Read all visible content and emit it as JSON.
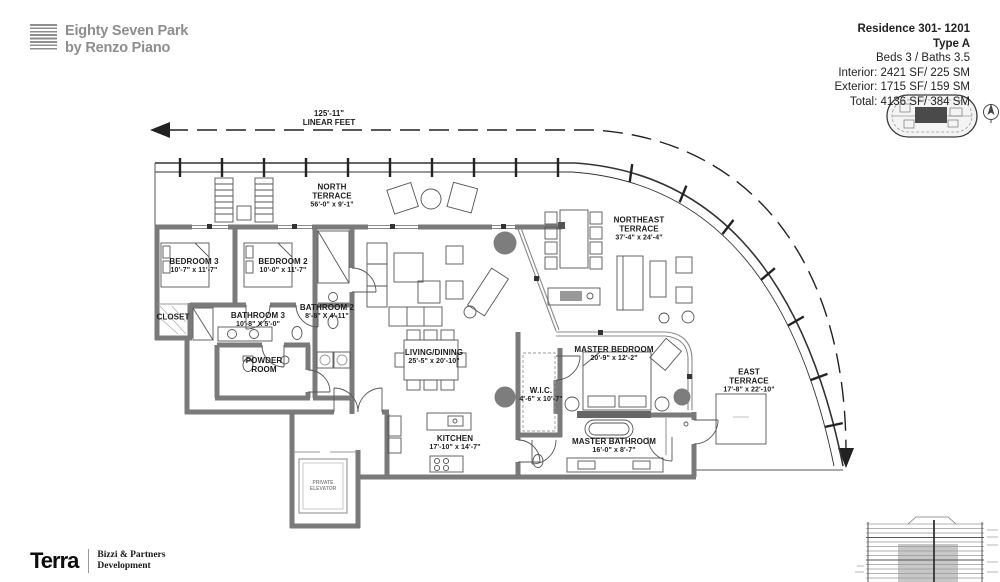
{
  "header": {
    "brand": {
      "line1": "Eighty Seven Park",
      "line2": "by Renzo Piano"
    },
    "residence": {
      "title": "Residence 301- 1201",
      "type": "Type A",
      "beds_baths": "Beds 3 / Baths 3.5",
      "interior": "Interior: 2421 SF/ 225 SM",
      "exterior": "Exterior: 1715 SF/ 159 SM",
      "total": "Total: 4136 SF/ 384 SM"
    }
  },
  "dimension_line": {
    "value": "125'-11\"",
    "label": "LINEAR FEET"
  },
  "rooms": {
    "north_terrace": {
      "name1": "NORTH",
      "name2": "TERRACE",
      "dims": "56'-0\" x 9'-1\""
    },
    "northeast_terrace": {
      "name1": "NORTHEAST",
      "name2": "TERRACE",
      "dims": "37'-4\" x 24'-4\""
    },
    "east_terrace": {
      "name1": "EAST",
      "name2": "TERRACE",
      "dims": "17'-8\" x 22'-10\""
    },
    "bedroom_3": {
      "name": "BEDROOM 3",
      "dims": "10'-7\" x 11'-7\""
    },
    "bedroom_2": {
      "name": "BEDROOM 2",
      "dims": "10'-0\" x 11'-7\""
    },
    "closet": {
      "name": "CLOSET"
    },
    "bathroom_3": {
      "name": "BATHROOM 3",
      "dims": "10'-8\" X 5'-0\""
    },
    "bathroom_2": {
      "name": "BATHROOM 2",
      "dims": "8'-8\" X 4'-11\""
    },
    "powder_room": {
      "name1": "POWDER",
      "name2": "ROOM"
    },
    "living_dining": {
      "name": "LIVING/DINING",
      "dims": "25'-5\" x 20'-10\""
    },
    "wic": {
      "name": "W.I.C.",
      "dims": "4'-6\" x 10'-7\""
    },
    "kitchen": {
      "name": "KITCHEN",
      "dims": "17'-10\" x 14'-7\""
    },
    "master_bedroom": {
      "name": "MASTER BEDROOM",
      "dims": "20'-9\" x 12'-2\""
    },
    "master_bathroom": {
      "name": "MASTER BATHROOM",
      "dims": "16'-0\" x 8'-7\""
    },
    "private_elevator": {
      "name1": "PRIVATE",
      "name2": "ELEVATOR"
    }
  },
  "footer": {
    "developer": "Terra",
    "partner_line1": "Bizzi & Partners",
    "partner_line2": "Development"
  },
  "icons": {
    "brand_logo": "stacked-lines-logo",
    "keyplan": "building-keyplan",
    "compass": "north-arrow-compass",
    "section_thumbnail": "building-section-thumbnail"
  },
  "colors": {
    "wall": "#7a7a7a",
    "line": "#2e2e2e",
    "glass": "#8a8a8a",
    "text": "#1c1c1c",
    "brand_gray": "#8e8e8e",
    "plant": "#7d7d7d"
  }
}
